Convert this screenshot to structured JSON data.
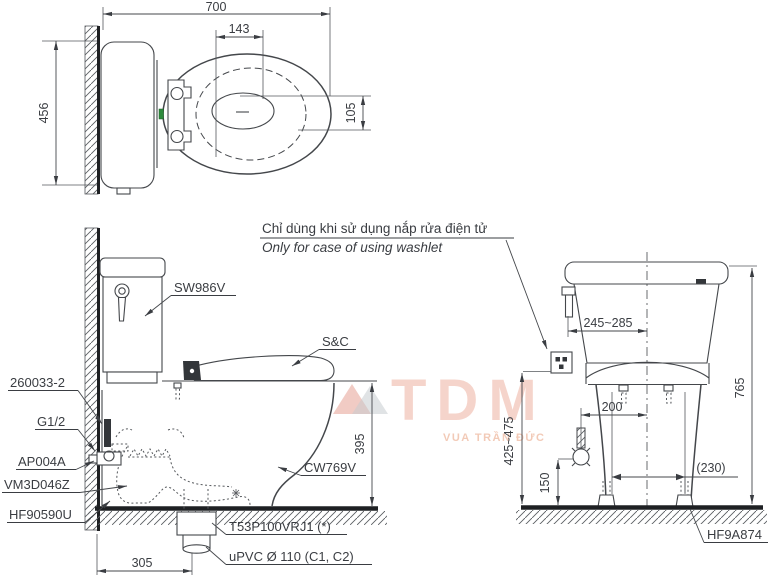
{
  "note": {
    "vi": "Chỉ dùng khi sử dụng nắp rửa điện tử",
    "en": "Only for case of using washlet"
  },
  "top_view": {
    "dim_width": "700",
    "dim_hinge": "143",
    "dim_offset": "105",
    "dim_depth": "456"
  },
  "side_view": {
    "label_tank": "SW986V",
    "label_seat": "S&C",
    "label_bowl": "CW769V",
    "label_hose": "260033-2",
    "label_thread": "G1/2",
    "label_valve": "AP004A",
    "label_connector": "VM3D046Z",
    "label_flange": "HF90590U",
    "label_drain_joint": "T53P100VRJ1 (*)",
    "label_drain_pipe": "uPVC Ø 110 (C1, C2)",
    "dim_rim_height": "395",
    "dim_drain_setout": "305"
  },
  "front_view": {
    "label_bolt_cap": "HF9A874",
    "dim_lever_offset": "245~285",
    "dim_total_height": "765",
    "dim_supply_offset": "200",
    "dim_outlet_range": "425~475",
    "dim_supply_height": "150",
    "dim_bolt_span": "(230)"
  },
  "watermark": {
    "logo": "TDM",
    "tagline": "VUA TRẦN ĐỨC"
  }
}
